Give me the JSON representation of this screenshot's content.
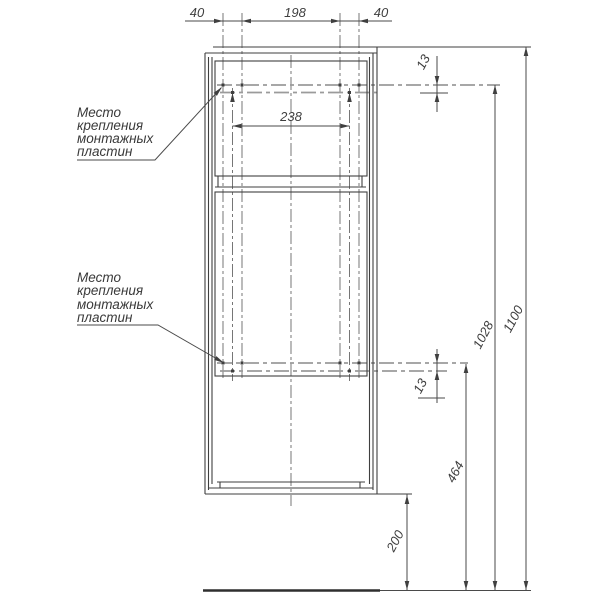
{
  "drawing": {
    "background": "#ffffff",
    "colors": {
      "structure": "#3f3f3f",
      "dimension": "#4a4a4a",
      "plate_line": "#9b9b9b",
      "floor": "#2f2f2f"
    },
    "notes": {
      "top": {
        "line1": "Место",
        "line2": "крепления",
        "line3": "монтажных",
        "line4": "пластин"
      },
      "bottom": {
        "line1": "Место",
        "line2": "крепления",
        "line3": "монтажных",
        "line4": "пластин"
      }
    },
    "dims": {
      "top_left_offset": "40",
      "top_center_span": "198",
      "top_right_offset": "40",
      "plate_center_span": "238",
      "top_hole_row_gap": "13",
      "bottom_hole_row_gap": "13",
      "total_height": "1100",
      "top_plate_height": "1028",
      "bottom_plate_height": "464",
      "floor_clearance": "200"
    }
  }
}
